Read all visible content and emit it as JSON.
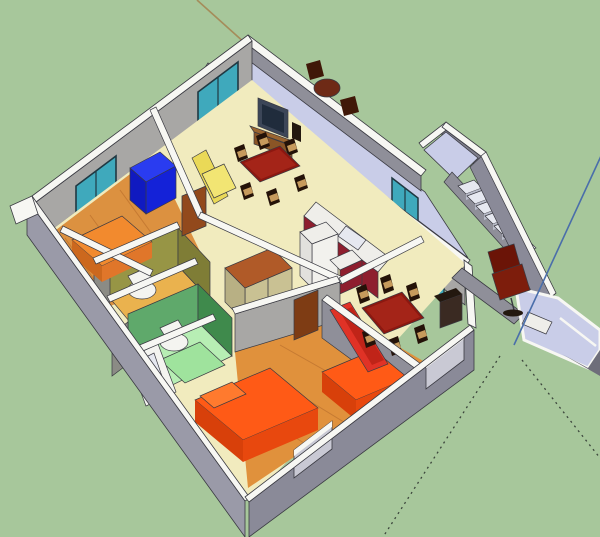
{
  "viewport": {
    "width": 600,
    "height": 537,
    "kind": "3d-model-view",
    "description": "Axonometric dollhouse view of a single-story house model on a green ground plane, SketchUp-style, no UI chrome visible"
  },
  "palette": {
    "ground": "#a7c79b",
    "wallTop": "#f7f7f3",
    "wallFaceLight": "#b3b2b0",
    "wallFaceMid": "#a8a7a5",
    "wallFaceDark": "#8f8f99",
    "wallFaceOuter": "#9a9aa8",
    "wallFaceOuterDark": "#8a8a98",
    "parapetDark": "#7e7e8c",
    "floorYellow": "#f1ebbe",
    "floorWood": "#dc9140",
    "floorWoodStreak": "#c57a32",
    "floorWoodF": "#e0913c",
    "floorLavender": "#c9cde8",
    "stepLight": "#e6e8f0",
    "stepRiser": "#b9bcc9",
    "bathOliveLight": "#979545",
    "bathOliveDark": "#7f7d36",
    "bathFloorYellow": "#eab24e",
    "bathGreenLight": "#5fa96b",
    "bathGreenDark": "#3f8a4c",
    "bathFloorMint": "#b7eeb4",
    "mintMat": "#9fe39d",
    "white": "#f4f4f0",
    "glassTeal": "#3fa9bc",
    "glassFrame": "#203842",
    "windowPale": "#c9c9d4",
    "bedOrange": "#ff5a16",
    "bedOrangeSide": "#e8480e",
    "bedOrangeDark": "#d8400a",
    "pillowOrange": "#ff7a2e",
    "bedSoftOrange": "#f28a2e",
    "bedSoftOrangeSide": "#e0762a",
    "bedSoftOrangeDark": "#cc681e",
    "sofaBlueTop": "#2a3cf0",
    "sofaBlueFront": "#1422d8",
    "sofaBlueSide": "#101ac0",
    "sofaYellowBack": "#ead957",
    "sofaYellowSeat": "#f2e573",
    "sofaRed": "#e03226",
    "sofaRedDark": "#c02418",
    "tableRed": "#8c1810",
    "tableRedLight": "#a42418",
    "chairDark": "#241208",
    "chairSeatTan": "#c69a5c",
    "woodBrown": "#8a5526",
    "woodBrownLight": "#9a6530",
    "doorBrown": "#92491c",
    "doorBrownDark": "#7e3c14",
    "wardrobeTop": "#b05a28",
    "wardrobeDoors": "#c9c193",
    "wardrobeSide": "#b8b084",
    "cabinetMaroon": "#8e1e2e",
    "counterWhite": "#efeeea",
    "fridgeFront": "#f2f1ed",
    "fridgeSide": "#e2e1dd",
    "tvBody": "#3c4658",
    "tvScreen": "#202c3c",
    "darkCabinet": "#3a2a22",
    "darkCabinetTop": "#23180f",
    "balconyFurniture": "#6e2a16",
    "balconyChair": "#401808",
    "officeChairBack": "#6b1407",
    "officeChairSeat": "#7d1d0c",
    "grayDoor": "#8b8b85",
    "edge": "#3a3a42",
    "axisBlue": "#4a6eaa",
    "axisTan": "#a58c5a",
    "axisDotted": "#3c463c",
    "rampShadow": "#6e6e7a"
  },
  "axes": {
    "blue_axis": {
      "style": "solid",
      "color_key": "axisBlue",
      "note": "vertical model axis rising from origin near entrance porch"
    },
    "tan_axis": {
      "style": "solid",
      "color_key": "axisTan",
      "note": "axis line emerging top-left beyond the house"
    },
    "negative_axes": {
      "style": "dotted",
      "color_key": "axisDotted",
      "note": "two dotted negative-direction axis lines radiating onto the ground at lower right"
    }
  },
  "scene": {
    "ground": "green ground plane",
    "structures": [
      {
        "name": "balcony-terrace",
        "detail": "lavender-floored terrace along the top edge with parapet walls and a dark wood table with two chairs"
      },
      {
        "name": "stair-landing",
        "detail": "small parapet landing jutting out to the upper right"
      },
      {
        "name": "outdoor-staircase",
        "detail": "staircase with seven treads descending to the entrance porch"
      },
      {
        "name": "entrance-porch",
        "detail": "lavender entry platform and ramp with white trim, small white table and a dark red office chair"
      }
    ],
    "rooms": [
      {
        "name": "lounge",
        "floor": "pale yellow",
        "contents": [
          "tv on stand",
          "dark red dining table with chairs",
          "yellow sofa",
          "teal sliding door to balcony",
          "teal window"
        ]
      },
      {
        "name": "kitchen",
        "floor": "pale yellow",
        "contents": [
          "maroon cabinets with white countertop",
          "sink",
          "white fridge",
          "teal glazed door to stairs"
        ]
      },
      {
        "name": "bedroom-blue-sofa",
        "floor": "orange wood",
        "contents": [
          "blue sofa",
          "teal window"
        ]
      },
      {
        "name": "bedroom-left",
        "floor": "orange wood",
        "contents": [
          "soft orange bed",
          "brown door"
        ]
      },
      {
        "name": "bathroom-olive",
        "walls": "olive green",
        "floor": "orange yellow",
        "contents": [
          "toilet",
          "gray door"
        ]
      },
      {
        "name": "bathroom-green",
        "walls": "green",
        "floor": "mint",
        "contents": [
          "toilet",
          "white bathtub",
          "mint mat",
          "gray door"
        ]
      },
      {
        "name": "bedroom-double",
        "floor": "orange wood",
        "contents": [
          "two bright orange beds",
          "brown door",
          "window in outer wall"
        ]
      },
      {
        "name": "dining-living-room",
        "floor": "pale yellow",
        "contents": [
          "dark red dining table with six chairs",
          "red sofa",
          "dark cabinet",
          "teal window",
          "window in outer wall"
        ]
      },
      {
        "name": "hallway",
        "floor": "pale yellow",
        "contents": [
          "wardrobe with brown top and khaki doors"
        ]
      }
    ]
  }
}
